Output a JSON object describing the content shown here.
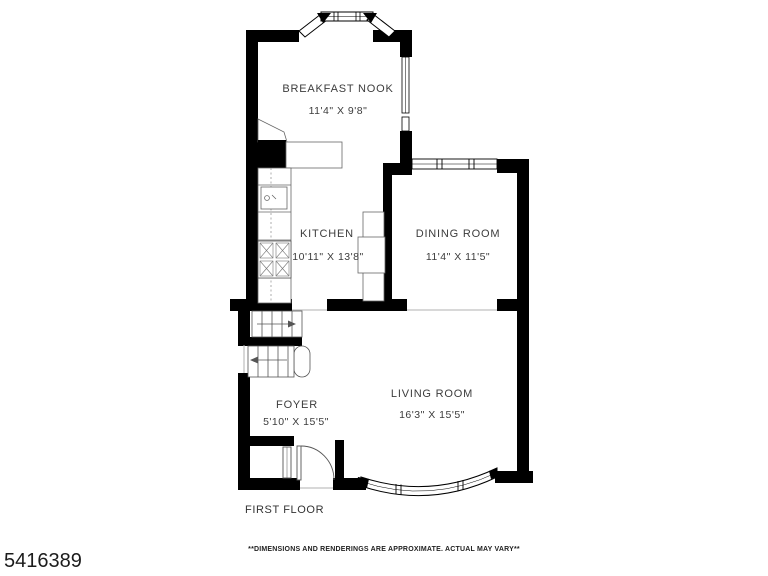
{
  "listing_id": "5416389",
  "floor_label": "FIRST FLOOR",
  "disclaimer": "**DIMENSIONS AND RENDERINGS ARE APPROXIMATE. ACTUAL MAY VARY**",
  "rooms": {
    "breakfast_nook": {
      "name": "BREAKFAST NOOK",
      "dims": "11'4\" X 9'8\""
    },
    "kitchen": {
      "name": "KITCHEN",
      "dims": "10'11\" X 13'8\""
    },
    "dining_room": {
      "name": "DINING ROOM",
      "dims": "11'4\" X 11'5\""
    },
    "living_room": {
      "name": "LIVING ROOM",
      "dims": "16'3\" X 15'5\""
    },
    "foyer": {
      "name": "FOYER",
      "dims": "5'10\" X 15'5\""
    }
  },
  "colors": {
    "wall": "#000000",
    "text": "#3c3c3c",
    "fixture_line": "#666666",
    "background": "#ffffff"
  }
}
